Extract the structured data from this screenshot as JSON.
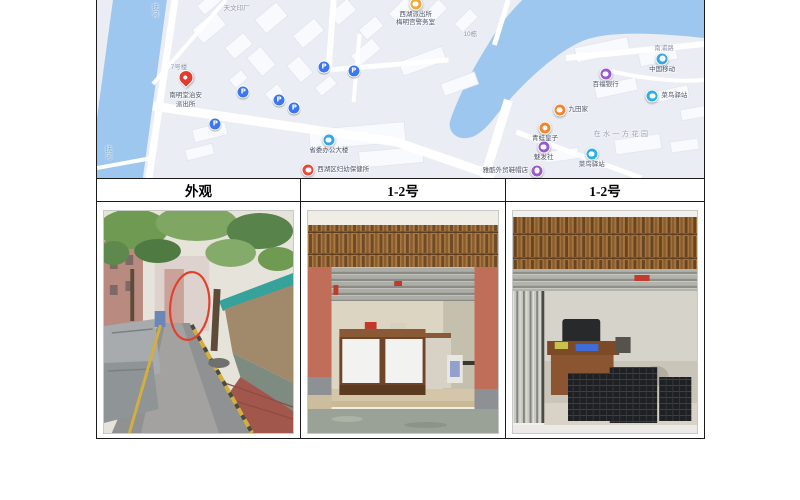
{
  "document": {
    "table": {
      "headers": [
        "外观",
        "1-2号",
        "1-2号"
      ]
    },
    "photos": [
      {
        "name": "alley-exterior-photo"
      },
      {
        "name": "shop-1-2-front-photo"
      },
      {
        "name": "shop-1-2-interior-photo"
      }
    ]
  },
  "map": {
    "colors": {
      "water": "#9ec7ef",
      "land": "#eaedf4",
      "road": "#ffffff",
      "building": "#f8fafd",
      "parking": "#3c76f0",
      "pin": "#e23c30"
    },
    "parking_label": "P",
    "parking": [
      {
        "x": 24.1,
        "y": 51.7
      },
      {
        "x": 30.0,
        "y": 56.2
      },
      {
        "x": 32.5,
        "y": 60.7
      },
      {
        "x": 19.5,
        "y": 69.7
      },
      {
        "x": 37.4,
        "y": 37.6
      },
      {
        "x": 42.3,
        "y": 39.9
      }
    ],
    "pois": [
      {
        "name": "police-kiosk",
        "type": "pin",
        "color": "#e23c30",
        "x": 14.6,
        "y": 47.8,
        "label": [
          "南明堂治安",
          "派出所"
        ],
        "label_pos": "below"
      },
      {
        "name": "police-station",
        "type": "circle",
        "color": "#f0a93c",
        "x": 52.5,
        "y": 2.2,
        "label": [
          "西湖派出所",
          "梅明宫警务室"
        ],
        "label_pos": "below"
      },
      {
        "name": "gov-office",
        "type": "circle",
        "color": "#35a6e8",
        "x": 38.2,
        "y": 78.7,
        "label": [
          "省委办公大楼"
        ],
        "label_pos": "below"
      },
      {
        "name": "clinic",
        "type": "circle",
        "color": "#e8483a",
        "x": 34.8,
        "y": 95.5,
        "label": [
          "西湖区妇幼保健所"
        ],
        "label_pos": "right"
      },
      {
        "name": "china-mobile",
        "type": "circle",
        "color": "#35a6e8",
        "x": 93.1,
        "y": 33.0,
        "label": [
          "中国移动"
        ],
        "label_pos": "below"
      },
      {
        "name": "bank",
        "type": "circle",
        "color": "#9b59d0",
        "x": 83.8,
        "y": 41.6,
        "label": [
          "百福银行"
        ],
        "label_pos": "below"
      },
      {
        "name": "cainiao-station-1",
        "type": "circle",
        "color": "#29b0e8",
        "x": 91.5,
        "y": 53.9,
        "label": [
          "菜鸟驿站"
        ],
        "label_pos": "right"
      },
      {
        "name": "restaurant",
        "type": "circle",
        "color": "#f2862c",
        "x": 76.2,
        "y": 61.8,
        "label": [
          "九田家"
        ],
        "label_pos": "right"
      },
      {
        "name": "kids-shop",
        "type": "circle",
        "color": "#f2862c",
        "x": 73.8,
        "y": 71.9,
        "label": [
          "青蛙皇子"
        ],
        "label_pos": "below"
      },
      {
        "name": "hair-salon",
        "type": "circle",
        "color": "#9b59d0",
        "x": 73.6,
        "y": 82.6,
        "label": [
          "魅发社"
        ],
        "label_pos": "below"
      },
      {
        "name": "cainiao-station-2",
        "type": "circle",
        "color": "#29b0e8",
        "x": 81.5,
        "y": 86.5,
        "label": [
          "菜鸟驿站"
        ],
        "label_pos": "below"
      },
      {
        "name": "shoe-shop",
        "type": "circle",
        "color": "#9b59d0",
        "x": 72.5,
        "y": 96.0,
        "label": [
          "雅酷外贸鞋帽店"
        ],
        "label_pos": "left"
      }
    ],
    "road_labels": [
      {
        "text": "抚河",
        "x": 9.3,
        "y": 6,
        "vertical": true
      },
      {
        "text": "抚河",
        "x": 1.6,
        "y": 86,
        "vertical": true
      },
      {
        "text": "南浦路",
        "x": 93.4,
        "y": 26.5
      },
      {
        "text": "天文印厂",
        "x": 23,
        "y": 4
      },
      {
        "text": "10栋",
        "x": 61.5,
        "y": 18.5
      },
      {
        "text": "7号楼",
        "x": 13.5,
        "y": 37
      },
      {
        "text": "在水一方花园",
        "x": 86.5,
        "y": 75,
        "area": true
      }
    ]
  }
}
